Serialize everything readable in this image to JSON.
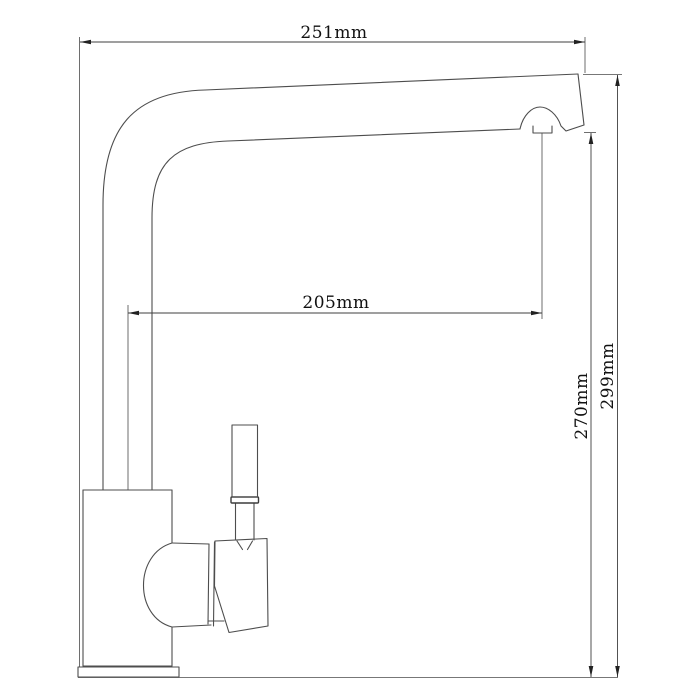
{
  "drawing": {
    "type": "technical-drawing",
    "subject": "kitchen faucet side elevation",
    "background_color": "#ffffff",
    "outline_color": "#4d4d4d",
    "dimension_line_color": "#3f3f3f",
    "text_color": "#111111",
    "dims": {
      "total_width": "251mm",
      "spout_reach": "205mm",
      "outlet_height": "270mm",
      "total_height": "299mm"
    }
  }
}
